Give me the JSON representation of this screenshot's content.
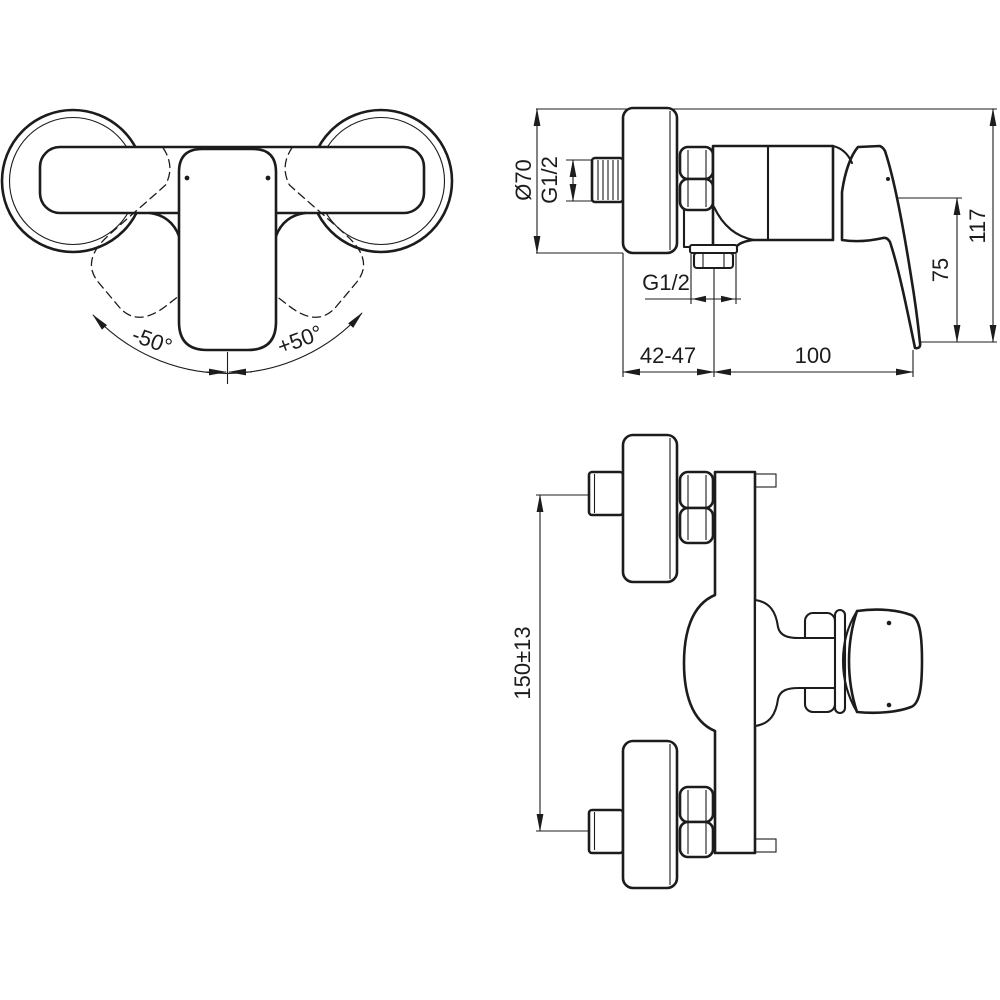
{
  "canvas": {
    "background": "#ffffff",
    "ink": "#1c1c1c"
  },
  "front_view": {
    "swing_left_label": "-50°",
    "swing_right_label": "+50°"
  },
  "side_view": {
    "escutcheon_diameter_label": "Ø70",
    "inlet_thread_label": "G1/2",
    "outlet_thread_label": "G1/2",
    "wall_distance_label": "42-47",
    "projection_label": "100",
    "handle_height_label": "75",
    "total_height_label": "117"
  },
  "top_view": {
    "pipe_spacing_label": "150±13"
  }
}
